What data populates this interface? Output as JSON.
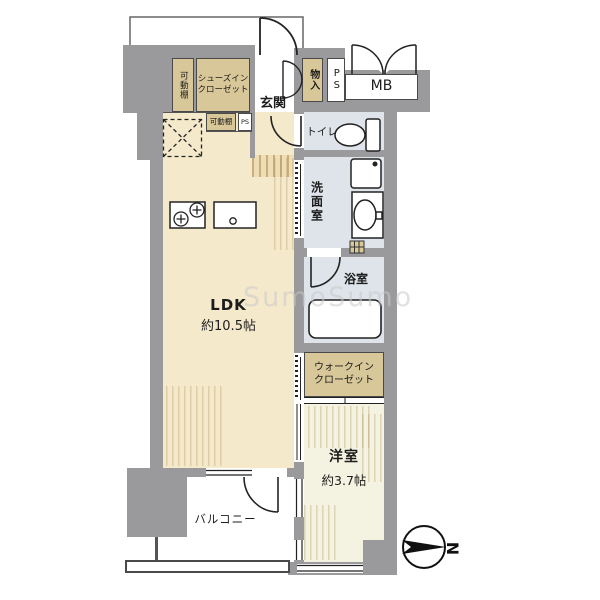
{
  "watermark": "SumoSumo",
  "compass": {
    "north": "N"
  },
  "rooms": {
    "ldk": {
      "name": "LDK",
      "size": "約10.5帖"
    },
    "western": {
      "name": "洋室",
      "size": "約3.7帖"
    },
    "balcony": {
      "name": "バルコニー"
    },
    "entrance": {
      "name": "玄関"
    },
    "toilet": {
      "name": "トイレ"
    },
    "washroom": {
      "name": "洗面室"
    },
    "bathroom": {
      "name": "浴室"
    },
    "walk_in_closet": {
      "line1": "ウォークイン",
      "line2": "クローゼット"
    },
    "shoe_closet": {
      "line1": "シューズイン",
      "line2": "クローゼット"
    },
    "shelf_tall": {
      "name": "可動棚"
    },
    "shelf_small": {
      "name": "可動棚"
    },
    "storage": {
      "name": "物入"
    },
    "pipe_space": {
      "name": "PS"
    },
    "pipe_space_small": {
      "name": "PS"
    },
    "meter_box": {
      "name": "MB"
    }
  },
  "colors": {
    "wall": "#9a9a9c",
    "ldk_floor": "#f5e9cc",
    "closet": "#d8c799",
    "wet_area": "#dee4ea",
    "western_floor": "#f4f2e0"
  }
}
